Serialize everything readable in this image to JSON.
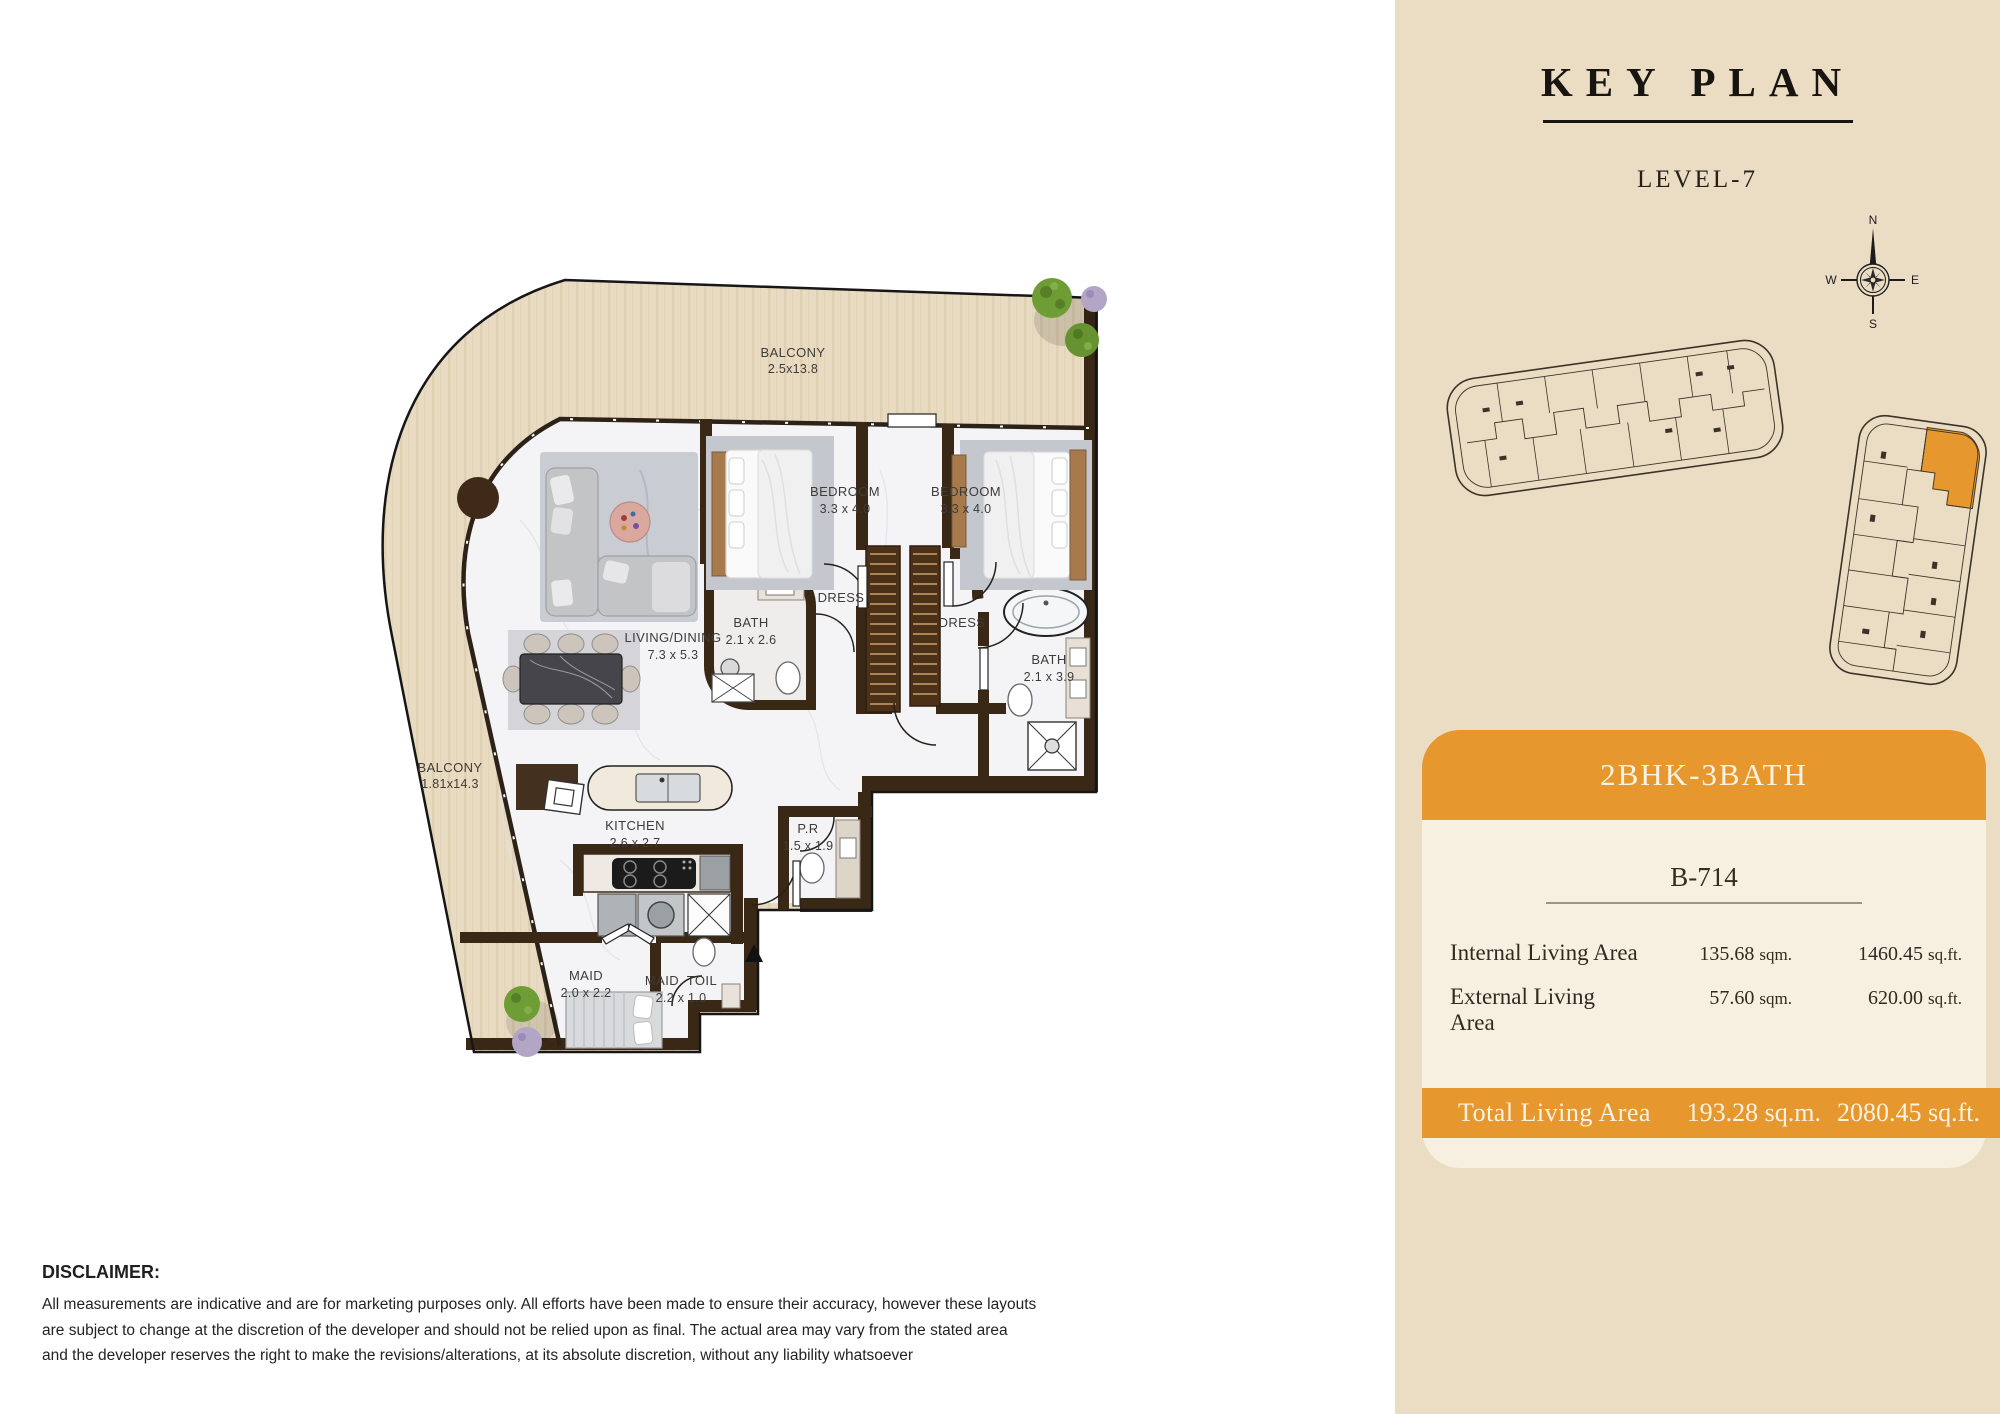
{
  "panel": {
    "title": "KEY PLAN",
    "subtitle": "LEVEL-7"
  },
  "compass": {
    "north": "N",
    "east": "E",
    "south": "S",
    "west": "W"
  },
  "unit_card": {
    "type_label": "2BHK-3BATH",
    "unit_number": "B-714",
    "rows": [
      {
        "label": "Internal Living Area",
        "sqm_value": "135.68",
        "sqm_unit": "sqm.",
        "sqft_value": "1460.45",
        "sqft_unit": "sq.ft."
      },
      {
        "label": "External Living Area",
        "sqm_value": "57.60",
        "sqm_unit": "sqm.",
        "sqft_value": "620.00",
        "sqft_unit": "sq.ft."
      }
    ],
    "total": {
      "label": "Total Living Area",
      "sqm": "193.28 sq.m.",
      "sqft": "2080.45 sq.ft."
    }
  },
  "floor_plan": {
    "rooms": [
      {
        "name": "BALCONY",
        "dims": "2.5x13.8"
      },
      {
        "name": "BEDROOM",
        "dims": "3.3 x 4.0"
      },
      {
        "name": "BEDROOM",
        "dims": "3.3 x 4.0"
      },
      {
        "name": "DRESS",
        "dims": ""
      },
      {
        "name": "DRESS",
        "dims": ""
      },
      {
        "name": "BATH",
        "dims": "2.1 x 2.6"
      },
      {
        "name": "BATH",
        "dims": "2.1 x 3.9"
      },
      {
        "name": "LIVING/DINING",
        "dims": "7.3 x 5.3"
      },
      {
        "name": "BALCONY",
        "dims": "1.81x14.3"
      },
      {
        "name": "KITCHEN",
        "dims": "2.6 x 2.7"
      },
      {
        "name": "P.R",
        "dims": "1.5 x 1.9"
      },
      {
        "name": "MAID",
        "dims": "2.0 x 2.2"
      },
      {
        "name": "MAID. TOIL",
        "dims": "2.2 x 1.0"
      }
    ]
  },
  "disclaimer": {
    "title": "DISCLAIMER:",
    "lines": [
      "All measurements are indicative and are for marketing purposes only. All efforts have been made to ensure their accuracy, however these layouts",
      "are subject to change at the discretion of the developer and should not be relied upon as final. The actual area may vary from the stated area",
      "and the developer reserves the right to make the revisions/alterations, at its absolute discretion, without any liability whatsoever"
    ]
  },
  "colors": {
    "accent_orange": "#E6982E",
    "panel_beige": "#EBDDC3",
    "card_bg": "#F7EFDF",
    "wall_brown": "#3A2817",
    "balcony_wood": "#E9DBC1"
  }
}
